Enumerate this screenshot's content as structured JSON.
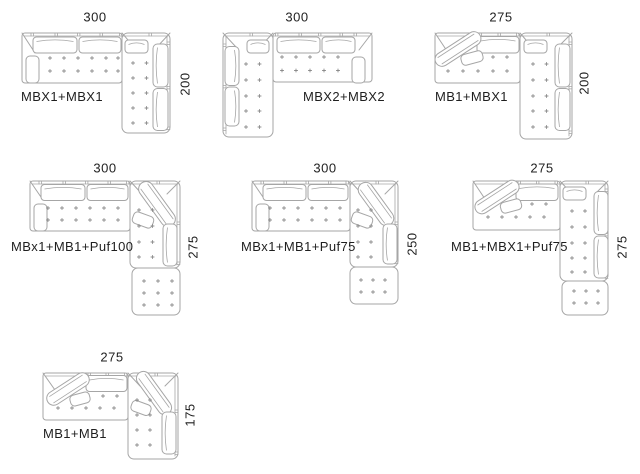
{
  "sheet": {
    "background": "#ffffff",
    "line_color": "#a6a6a6",
    "plus_color": "#8c8c8c",
    "text_color": "#1f1f1f"
  },
  "diagrams": [
    {
      "id": "mbx1-mbx1",
      "name": "MBX1+MBX1",
      "width_label": "300",
      "height_label": "200"
    },
    {
      "id": "mbx2-mbx2",
      "name": "MBX2+MBX2",
      "width_label": "300"
    },
    {
      "id": "mb1-mbx1",
      "name": "MB1+MBX1",
      "width_label": "275",
      "height_label": "200"
    },
    {
      "id": "mbx1-mb1-puf100",
      "name": "MBx1+MB1+Puf100",
      "width_label": "300",
      "height_label": "275"
    },
    {
      "id": "mbx1-mb1-puf75",
      "name": "MBx1+MB1+Puf75",
      "width_label": "300",
      "height_label": "250"
    },
    {
      "id": "mb1-mbx1-puf75",
      "name": "MB1+MBX1+Puf75",
      "width_label": "275",
      "height_label": "275"
    },
    {
      "id": "mb1-mb1",
      "name": "MB1+MB1",
      "width_label": "275",
      "height_label": "175"
    }
  ]
}
